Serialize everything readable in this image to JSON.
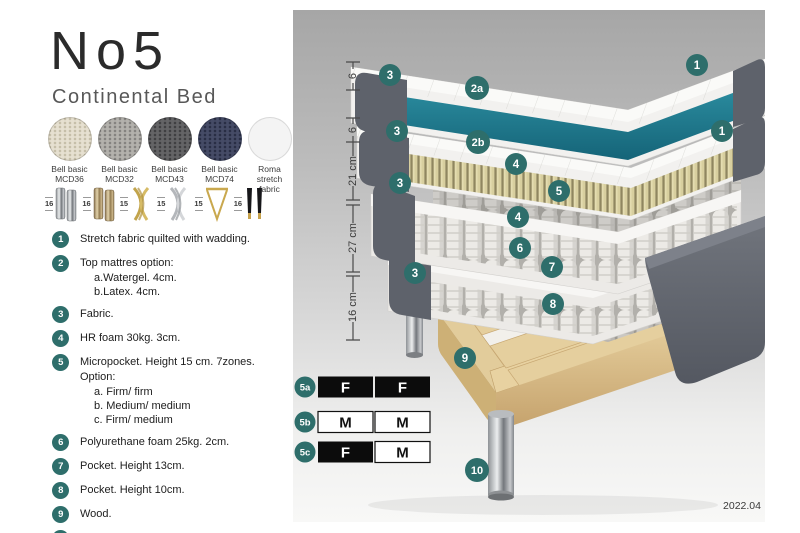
{
  "header": {
    "title": "No5",
    "subtitle": "Continental Bed"
  },
  "fabrics": [
    {
      "line1": "Bell basic",
      "line2": "MCD36",
      "color": "#e6e0d0"
    },
    {
      "line1": "Bell basic",
      "line2": "MCD32",
      "color": "#b3b1ac"
    },
    {
      "line1": "Bell basic",
      "line2": "MCD43",
      "color": "#646466"
    },
    {
      "line1": "Bell basic",
      "line2": "MCD74",
      "color": "#454b66"
    },
    {
      "line1": "Roma",
      "line2": "stretch fabric",
      "color": "#f4f4f4"
    }
  ],
  "legs": [
    {
      "height": "16",
      "type": "cylinder-silver"
    },
    {
      "height": "16",
      "type": "cylinder-brass"
    },
    {
      "height": "15",
      "type": "cross-gold"
    },
    {
      "height": "15",
      "type": "cross-silver"
    },
    {
      "height": "15",
      "type": "hairpin-gold"
    },
    {
      "height": "16",
      "type": "tapered-black-gold"
    }
  ],
  "legend": {
    "items": [
      {
        "num": "1",
        "text": "Stretch fabric quilted with wadding.",
        "subs": []
      },
      {
        "num": "2",
        "text": "Top mattres option:",
        "subs": [
          "a.Watergel. 4cm.",
          "b.Latex. 4cm."
        ]
      },
      {
        "num": "3",
        "text": "Fabric.",
        "subs": []
      },
      {
        "num": "4",
        "text": "HR foam 30kg. 3cm.",
        "subs": []
      },
      {
        "num": "5",
        "text": "Micropocket. Height 15 cm. 7zones. Option:",
        "subs": [
          "a. Firm/ firm",
          "b. Medium/ medium",
          "c. Firm/ medium"
        ]
      },
      {
        "num": "6",
        "text": "Polyurethane foam 25kg. 2cm.",
        "subs": []
      },
      {
        "num": "7",
        "text": "Pocket. Height 13cm.",
        "subs": []
      },
      {
        "num": "8",
        "text": "Pocket. Height 10cm.",
        "subs": []
      },
      {
        "num": "9",
        "text": "Wood.",
        "subs": []
      },
      {
        "num": "10",
        "text": "Metal leg. Height 16cm.",
        "subs": []
      }
    ]
  },
  "diagram": {
    "measurements": [
      {
        "label": "6"
      },
      {
        "label": "6"
      },
      {
        "label": "21 cm"
      },
      {
        "label": "27 cm"
      },
      {
        "label": "16 cm"
      }
    ],
    "markers": [
      {
        "label": "3"
      },
      {
        "label": "2a"
      },
      {
        "label": "1"
      },
      {
        "label": "3"
      },
      {
        "label": "2b"
      },
      {
        "label": "1"
      },
      {
        "label": "4"
      },
      {
        "label": "5"
      },
      {
        "label": "4"
      },
      {
        "label": "3"
      },
      {
        "label": "6"
      },
      {
        "label": "7"
      },
      {
        "label": "3"
      },
      {
        "label": "8"
      },
      {
        "label": "9"
      },
      {
        "label": "10"
      }
    ],
    "options_table": {
      "rows": [
        {
          "id": "5a",
          "cells": [
            {
              "v": "F",
              "filled": true
            },
            {
              "v": "F",
              "filled": true
            }
          ]
        },
        {
          "id": "5b",
          "cells": [
            {
              "v": "M",
              "filled": false
            },
            {
              "v": "M",
              "filled": false
            }
          ]
        },
        {
          "id": "5c",
          "cells": [
            {
              "v": "F",
              "filled": true
            },
            {
              "v": "M",
              "filled": false
            }
          ]
        }
      ]
    },
    "version": "2022.04",
    "accent_teal": "#2e6e6b",
    "core_teal": "#1f7d91",
    "fabric_gray": "#5e626b",
    "wood_color": "#e2cc9b"
  }
}
